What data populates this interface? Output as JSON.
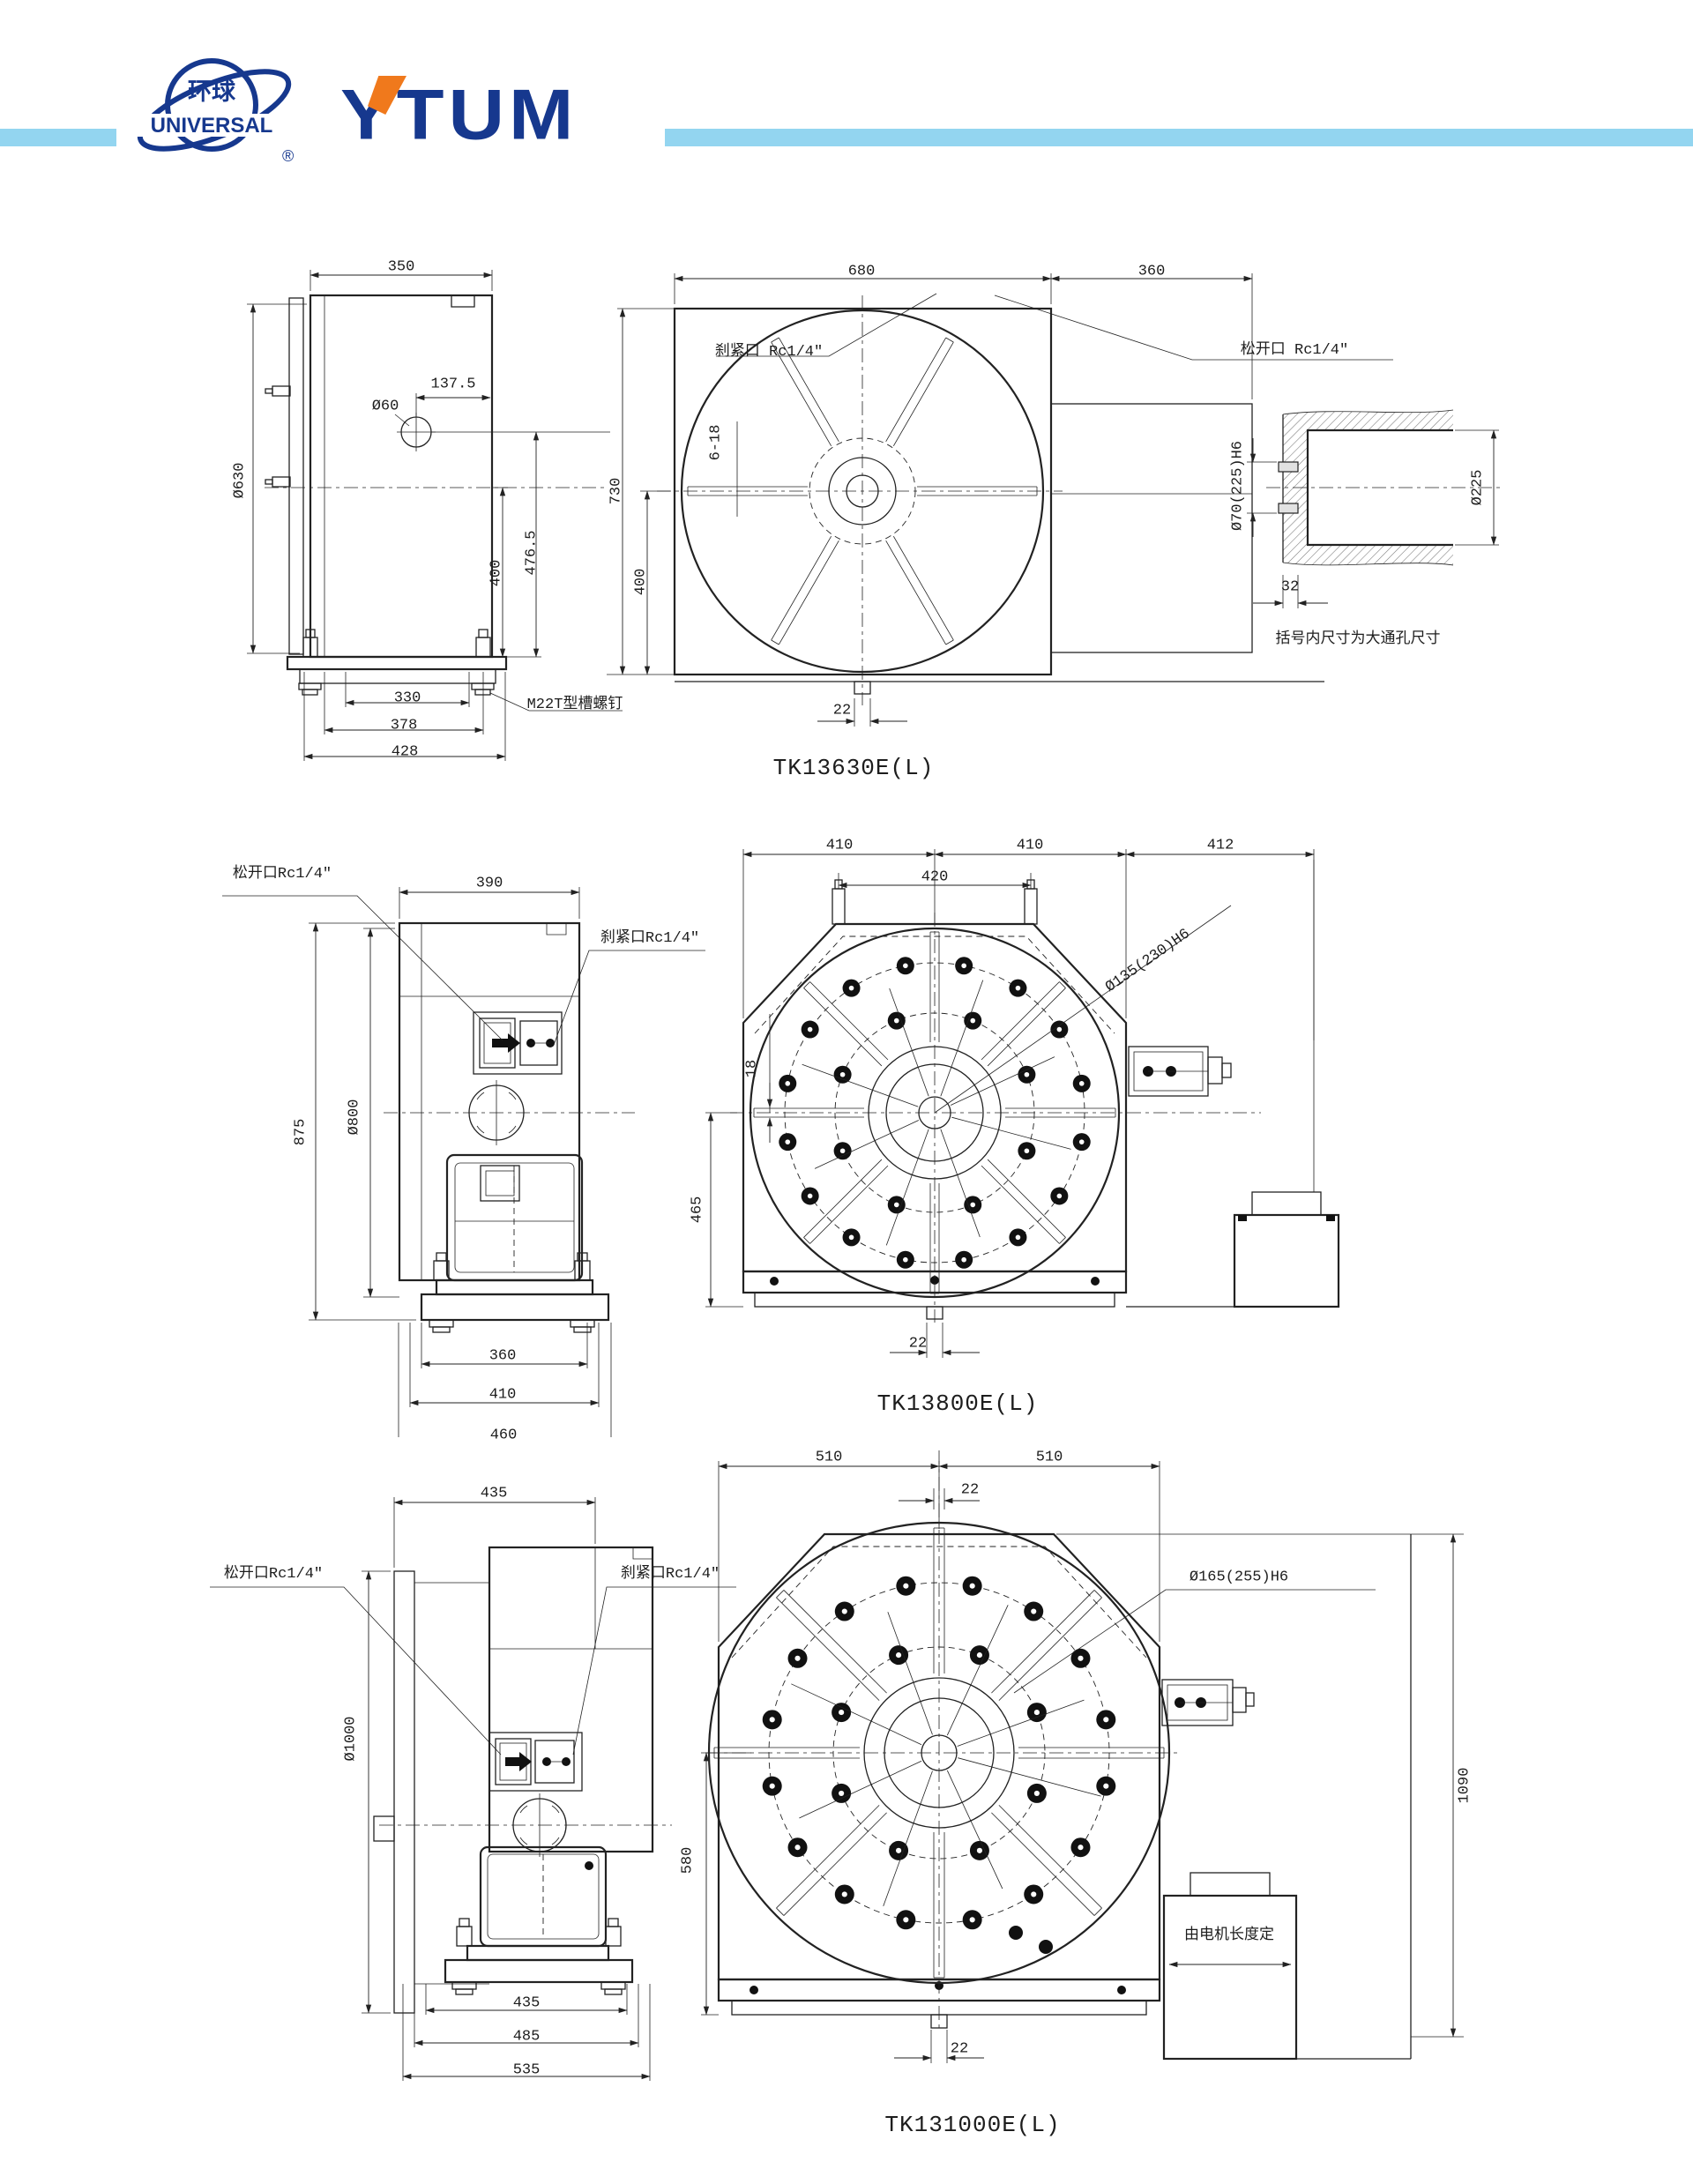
{
  "header": {
    "logo_globe_cn": "环球",
    "logo_globe_en": "UNIVERSAL",
    "logo_reg": "®",
    "logo_brand": "YTUM",
    "colors": {
      "navy": "#16388e",
      "orange": "#f0791c",
      "light_blue": "#93d5f0"
    }
  },
  "drawings": [
    {
      "model": "TK13630E(L)",
      "side_view": {
        "dim_width_top": "350",
        "dim_face_diameter": "Ø630",
        "dim_center_offset": "137.5",
        "label_hole": "Ø60",
        "dim_height_400": "400",
        "dim_height_476_5": "476.5",
        "dim_base_330": "330",
        "dim_base_378": "378",
        "dim_base_428": "428",
        "label_tslot_bolt": "M22T型槽螺钉"
      },
      "front_view": {
        "dim_width_680": "680",
        "dim_width_360": "360",
        "dim_height_730": "730",
        "dim_height_400": "400",
        "label_clamp_port": "刹紧口 Rc1/4″",
        "label_release_port": "松开口 Rc1/4″",
        "label_tslots": "6-18",
        "dim_key_22": "22"
      },
      "section_view": {
        "dim_bore": "Ø70(225)H6",
        "dim_spigot": "Ø225",
        "dim_depth_32": "32",
        "note": "括号内尺寸为大通孔尺寸"
      }
    },
    {
      "model": "TK13800E(L)",
      "side_view": {
        "label_release_port": "松开口Rc1/4″",
        "dim_width_390": "390",
        "label_clamp_port": "刹紧口Rc1/4″",
        "dim_height_875": "875",
        "dim_face_diameter": "Ø800",
        "dim_base_360": "360",
        "dim_base_410": "410",
        "dim_base_460": "460"
      },
      "front_view": {
        "dim_410_left": "410",
        "dim_410_right": "410",
        "dim_412": "412",
        "dim_eyebolt_420": "420",
        "label_bore": "Ø135(230)H6",
        "label_slot_18": "18",
        "dim_height_465": "465",
        "dim_key_22": "22"
      }
    },
    {
      "model": "TK131000E(L)",
      "side_view": {
        "dim_width_top_435": "435",
        "label_release_port": "松开口Rc1/4″",
        "label_clamp_port": "刹紧口Rc1/4″",
        "dim_face_diameter": "Ø1000",
        "dim_base_435": "435",
        "dim_base_485": "485",
        "dim_base_535": "535"
      },
      "front_view": {
        "dim_510_left": "510",
        "dim_510_right": "510",
        "dim_key_22_top": "22",
        "label_bore": "Ø165(255)H6",
        "dim_height_580": "580",
        "dim_height_1090": "1090",
        "label_motor": "由电机长度定",
        "dim_key_22_bottom": "22"
      }
    }
  ]
}
